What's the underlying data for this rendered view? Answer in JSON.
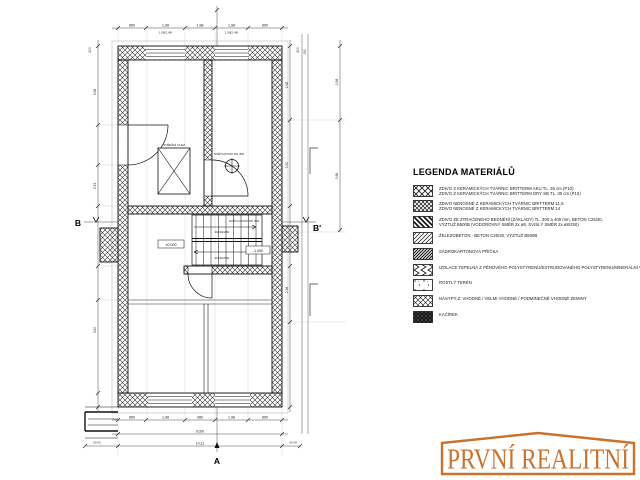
{
  "plan": {
    "markers": {
      "a": "A",
      "b": "B",
      "b_prime": "B'"
    },
    "labels": {
      "roof_hatch": "STŘEŠNÍ VLEZ",
      "skylight": "SVĚTLOVOD DN 400",
      "skylight2": "SVĚTLOVOD DN 400",
      "stairs_flight1": "9x181/250",
      "stairs_flight2": "9x181/250",
      "level_zero": "±0,000",
      "level_minus": "-1,050"
    },
    "dims": {
      "top": [
        "850",
        "1,98",
        "1,88",
        "1,98",
        "850"
      ],
      "top_sub": [
        "1,98(2,48)",
        "1,98(2,48)"
      ],
      "bottom": [
        "850",
        "1,98",
        "980",
        "1,98",
        "850"
      ],
      "total_mm": "9160",
      "total_m": "10,11",
      "corner_left": "50,42",
      "corner_right": "50,48",
      "left": [
        "3,98",
        "2,53",
        "3,60"
      ],
      "right": [
        "2,58",
        "1,50",
        "2,98"
      ],
      "far_right": [
        "2,98",
        "3,98"
      ],
      "top_left_rot": "300",
      "top_right_rot": [
        "300",
        "150"
      ]
    }
  },
  "legend": {
    "title": "LEGENDA MATERIÁLŮ",
    "items": [
      {
        "pattern": "crosshatch",
        "lines": [
          "ZDIVO Z KERAMICKÝCH TVÁRNIC BRITTERM AKU TL. 25 cm (P10)",
          "ZDIVO Z KERAMICKÝCH TVÁRNIC BRITTERM DRY SB TL. 30 cm (P10)"
        ]
      },
      {
        "pattern": "crosshatch-dense",
        "lines": [
          "ZDIVO NENOSNÉ Z KERAMICKÝCH TVÁRNIC BRITTERM 11,5",
          "ZDIVO NENOSNÉ Z KERAMICKÝCH TVÁRNIC BRITTERM 14"
        ]
      },
      {
        "pattern": "stripes-bold",
        "lines": [
          "ZDIVO ZE ZTRACENÉHO BEDNĚNÍ (ZÁKLADY) TL. 300 a 400 mm, BETON C25/30,",
          "VÝZTUŽ B500B (VODOROVNÝ SMĚR 2x ø8, SVISLÝ SMĚR 2x ø8/250)"
        ]
      },
      {
        "pattern": "stripes-thin",
        "lines": [
          "ŽELEZOBETON - BETON C25/30, VÝZTUŽ B500B"
        ]
      },
      {
        "pattern": "stripes-dark",
        "lines": [
          "SÁDROKARTONOVÁ PŘÍČKA"
        ]
      },
      {
        "pattern": "insulation",
        "lines": [
          "IZOLACE TEPELNÁ Z PĚNOVÉHO POLYSTYRENU/EXTRUDOVANÉHO POLYSTYRENU/MINERÁLNÍ VATY"
        ]
      },
      {
        "pattern": "dots",
        "lines": [
          "ROSTLÝ TERÉN"
        ]
      },
      {
        "pattern": "hatch-dots",
        "lines": [
          "NÁSYPY Z: VHODNÉ / VELMI VHODNÉ / PODMÍNEČNĚ VHODNÉ ZEMINY"
        ]
      },
      {
        "pattern": "solid-dark",
        "lines": [
          "KAČÍREK"
        ]
      }
    ]
  },
  "logo": {
    "text": "PRVNÍ REALITNÍ",
    "accent_color": "#c9722e"
  }
}
